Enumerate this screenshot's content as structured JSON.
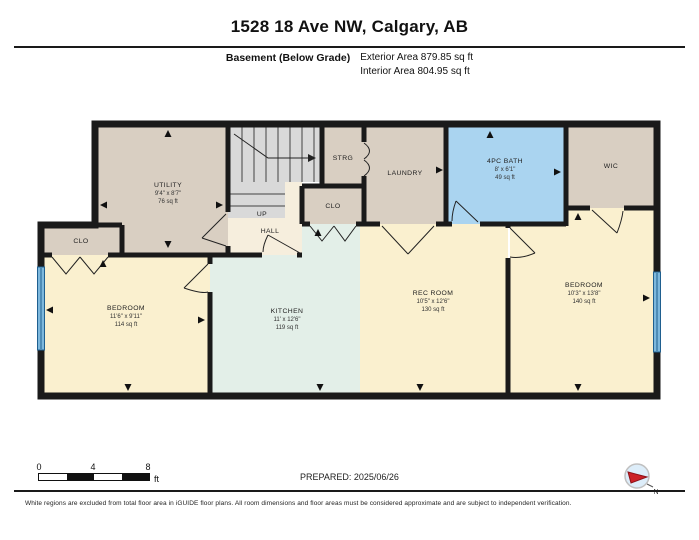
{
  "header": {
    "title": "1528 18 Ave NW, Calgary, AB",
    "floor_label": "Basement (Below Grade)",
    "exterior_area": "Exterior Area 879.85 sq ft",
    "interior_area": "Interior Area 804.95 sq ft"
  },
  "rooms": {
    "utility": {
      "name": "UTILITY",
      "dims": "9'4\" x 8'7\"",
      "area": "76 sq ft"
    },
    "strg": {
      "name": "STRG"
    },
    "clo_mid": {
      "name": "CLO"
    },
    "laundry": {
      "name": "LAUNDRY"
    },
    "bath": {
      "name": "4PC BATH",
      "dims": "8' x 6'1\"",
      "area": "49 sq ft"
    },
    "wic": {
      "name": "WIC"
    },
    "up": {
      "name": "UP"
    },
    "hall": {
      "name": "HALL"
    },
    "clo_left": {
      "name": "CLO"
    },
    "bedroom_left": {
      "name": "BEDROOM",
      "dims": "11'6\" x 9'11\"",
      "area": "114 sq ft"
    },
    "kitchen": {
      "name": "KITCHEN",
      "dims": "11' x 12'6\"",
      "area": "119 sq ft"
    },
    "rec_room": {
      "name": "REC ROOM",
      "dims": "10'5\" x 12'6\"",
      "area": "130 sq ft"
    },
    "bedroom_right": {
      "name": "BEDROOM",
      "dims": "10'3\" x 13'8\"",
      "area": "140 sq ft"
    }
  },
  "scale_bar": {
    "tick_0": "0",
    "tick_4": "4",
    "tick_8": "8",
    "unit": "ft"
  },
  "footer": {
    "prepared": "PREPARED: 2025/06/26",
    "compass_label": "N",
    "disclaimer": "White regions are excluded from total floor area in iGUIDE floor plans. All room dimensions and floor areas must be considered approximate and are subject to independent verification."
  },
  "colors": {
    "wall": "#1a1a1a",
    "room_tan": "#d9cfc2",
    "room_cream": "#f6eedd",
    "room_yellow": "#faf0cf",
    "room_mint": "#e3efe8",
    "room_blue": "#aad4f0",
    "stairs_gray": "#d9d9d9",
    "window_blue": "#6aaed6",
    "compass_red": "#cc2127"
  }
}
